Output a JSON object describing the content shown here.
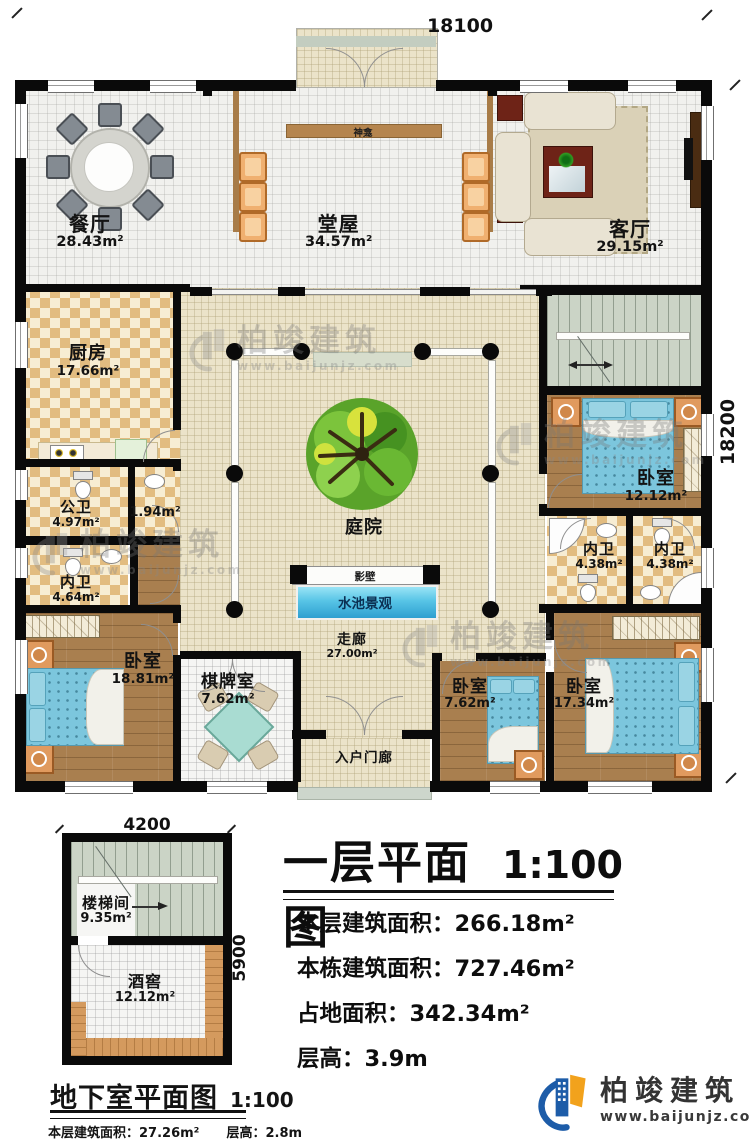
{
  "plan": {
    "dim_top": "18100",
    "dim_right": "18200",
    "rooms": {
      "dining": {
        "name": "餐厅",
        "area": "28.43m²"
      },
      "hall": {
        "name": "堂屋",
        "area": "34.57m²"
      },
      "living": {
        "name": "客厅",
        "area": "29.15m²"
      },
      "kitchen": {
        "name": "厨房",
        "area": "17.66m²"
      },
      "public_bath": {
        "name": "公卫",
        "area": "4.97m²"
      },
      "small_room": {
        "area": "1.94m²"
      },
      "inner_bath_left": {
        "name": "内卫",
        "area": "4.64m²"
      },
      "bedroom_left": {
        "name": "卧室",
        "area": "18.81m²"
      },
      "chess_room": {
        "name": "棋牌室",
        "area": "7.62m²"
      },
      "corridor": {
        "name": "走廊",
        "area": "27.00m²"
      },
      "courtyard": {
        "name": "庭院"
      },
      "entry_porch": {
        "name": "入户门廊"
      },
      "bedroom_right": {
        "name": "卧室",
        "area": "12.12m²"
      },
      "inner_bath_r1": {
        "name": "内卫",
        "area": "4.38m²"
      },
      "inner_bath_r2": {
        "name": "内卫",
        "area": "4.38m²"
      },
      "bedroom_small": {
        "name": "卧室",
        "area": "7.62m²"
      },
      "bedroom_se": {
        "name": "卧室",
        "area": "17.34m²"
      }
    },
    "features": {
      "shrine": "神龛",
      "screen_wall": "影壁",
      "pool": "水池景观"
    }
  },
  "basement": {
    "dim_top": "4200",
    "dim_right": "5900",
    "title": "地下室平面图",
    "scale": "1:100",
    "rooms": {
      "stairwell": {
        "name": "楼梯间",
        "area": "9.35m²"
      },
      "wine_cellar": {
        "name": "酒窖",
        "area": "12.12m²"
      }
    },
    "stats": [
      {
        "label": "本层建筑面积：",
        "value": "27.26m²"
      },
      {
        "label": "层高：",
        "value": "2.8m"
      }
    ]
  },
  "title_block": {
    "title": "一层平面图",
    "scale": "1:100",
    "stats": [
      {
        "label": "本层建筑面积：",
        "value": "266.18m²"
      },
      {
        "label": "本栋建筑面积：",
        "value": "727.46m²"
      },
      {
        "label": "占地面积：",
        "value": "342.34m²"
      },
      {
        "label": "层高：",
        "value": "3.9m"
      }
    ]
  },
  "branding": {
    "company": "柏竣建筑",
    "website": "www.baijunjz.com"
  },
  "colors": {
    "wall": "#0a0a0a",
    "courtyard": "#ebe3c9",
    "wood_floor": "#a97f4f",
    "tile_check": "#e2bc80",
    "pool_blue": "#57c4e6",
    "stair_green": "#cbd4c6",
    "logo_blue": "#1d5ca8",
    "logo_orange": "#f2a21c"
  }
}
